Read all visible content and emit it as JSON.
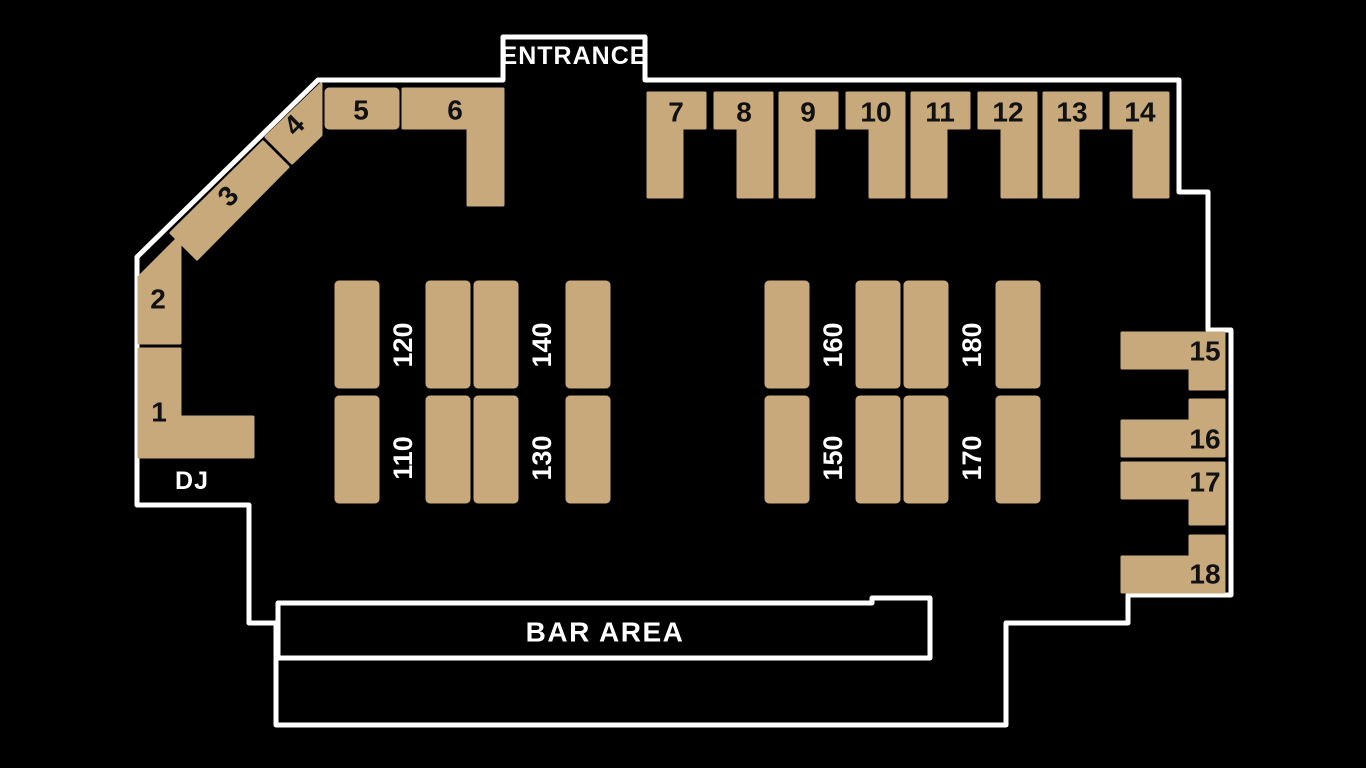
{
  "colors": {
    "background": "#000000",
    "outline": "#ffffff",
    "table_fill": "#c8a97c",
    "table_number": "#111111",
    "floor_label": "#ffffff"
  },
  "labels": {
    "entrance": "ENTRANCE",
    "dj": "DJ",
    "bar_area": "BAR AREA"
  },
  "tables": {
    "t1": "1",
    "t2": "2",
    "t3": "3",
    "t4": "4",
    "t5": "5",
    "t6": "6",
    "t7": "7",
    "t8": "8",
    "t9": "9",
    "t10": "10",
    "t11": "11",
    "t12": "12",
    "t13": "13",
    "t14": "14",
    "t15": "15",
    "t16": "16",
    "t17": "17",
    "t18": "18"
  },
  "sections": {
    "s110": "110",
    "s120": "120",
    "s130": "130",
    "s140": "140",
    "s150": "150",
    "s160": "160",
    "s170": "170",
    "s180": "180"
  }
}
